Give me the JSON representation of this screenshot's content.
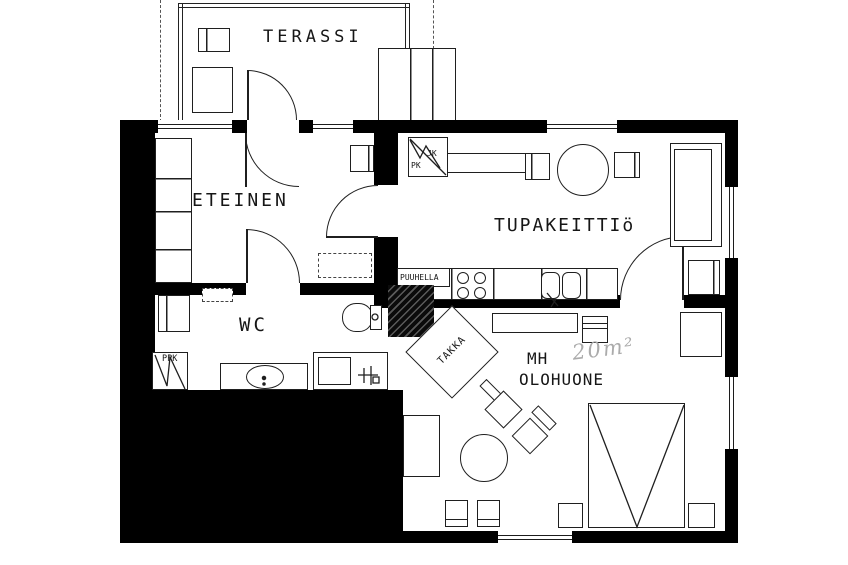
{
  "plan": {
    "title": "apartment-floor-plan-scan",
    "rooms": {
      "terassi": "TERASSI",
      "eteinen": "ETEINEN",
      "tupakeittio": "TUPAKEITTIö",
      "wc": "WC",
      "mh": "MH",
      "olohuone": "OLOHUONE"
    },
    "annotations": {
      "area_note": "20m²",
      "takka": "TAKKA",
      "puuhella": "PUUHELLA",
      "ppk": "PPK",
      "jk": "JK",
      "pk": "PK"
    },
    "colors": {
      "wall": "#000000",
      "line": "#1f1f1f",
      "floor": "#ffffff",
      "handwriting": "#ababab"
    }
  }
}
